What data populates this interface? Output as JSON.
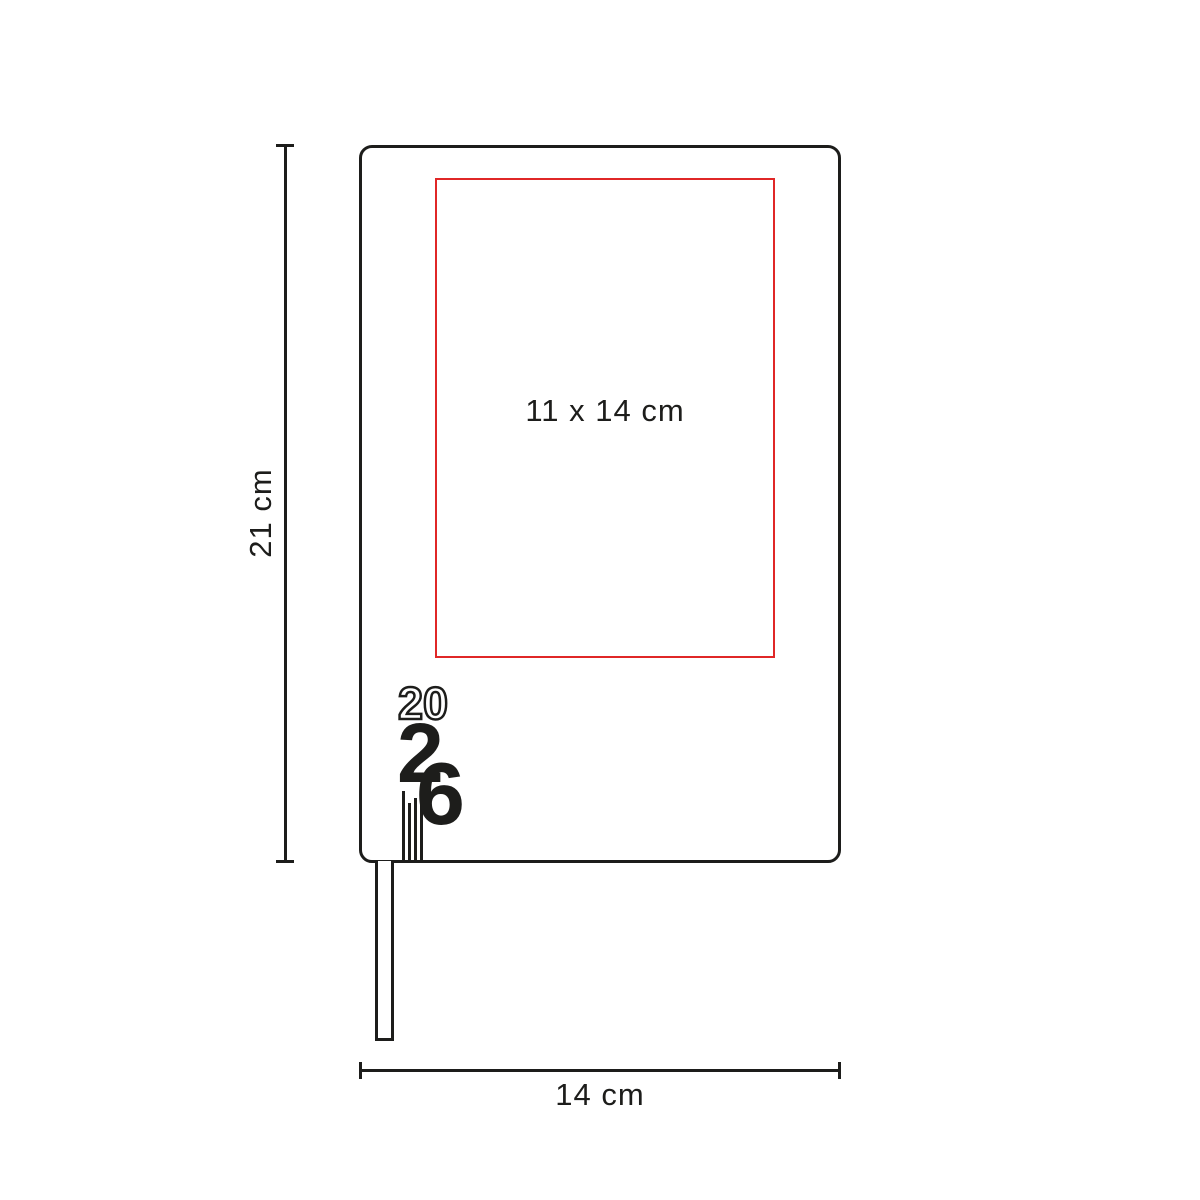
{
  "diagram": {
    "type": "product-dimension-diagram",
    "product": {
      "name": "notebook",
      "outline_color": "#1d1d1b",
      "background_color": "#ffffff"
    },
    "print_area": {
      "label": "11 x 14 cm",
      "border_color": "#e02727"
    },
    "logo": {
      "outline_text": "20",
      "solid_digit_left": "2",
      "solid_digit_right": "6",
      "color": "#1d1d1b"
    },
    "dimensions": {
      "height_label": "21 cm",
      "width_label": "14 cm"
    }
  }
}
